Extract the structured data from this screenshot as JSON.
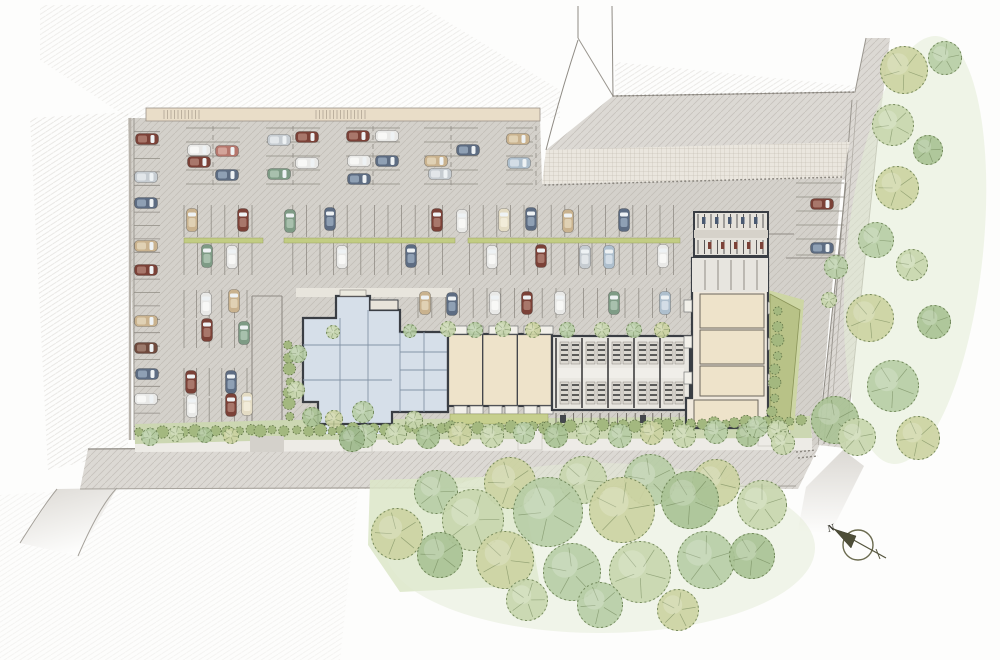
{
  "compass": {
    "label": "N"
  },
  "palette": {
    "background": "#fdfdfc",
    "asphalt": "#d4d1cb",
    "road": "#dcd9d4",
    "plaza": "#eae6de",
    "hatch_line": "#b4b0a8",
    "bg_hatch_line": "#d6d3ce",
    "curb": "#8f8b84",
    "stall_line": "#908c85",
    "wall_tan": "#e9ddc8",
    "building_wall": "#3a3e44",
    "clubhouse_fill": "#d6dfe9",
    "clubhouse_line": "#8494a6",
    "units_tan": "#eee3ca",
    "garage_fill": "#e9e7e1",
    "garage_unit": "#dcd9d2",
    "planter": "#c6cf8e",
    "median_green": "#c2cc83",
    "landscape_band": "#ccd7b2",
    "lawn": "#dce6c8",
    "sidewalk": "#edebe6",
    "green_wedge": "#b8c287",
    "shrub_fill": "#a3b87f",
    "shrub_stroke": "#5c6f42",
    "tree_stroke": "#5f7547",
    "compass_stroke": "#6b6b4f",
    "compass_fill": "#4e4e38",
    "greens": [
      "#c8d6ae",
      "#ccd2a2",
      "#b7cda6",
      "#a9c295",
      "#d8e0bf",
      "#9db88c"
    ]
  },
  "car_colors": {
    "maroon": [
      "#7b4137",
      "#a8776b"
    ],
    "brown": [
      "#6f4a3d",
      "#9c7a6c"
    ],
    "white": [
      "#e9e9e7",
      "#f8f8f6"
    ],
    "silver": [
      "#c6ccd1",
      "#e2e6e9"
    ],
    "slate": [
      "#5d6c82",
      "#8fa0b4"
    ],
    "lightblue": [
      "#aebfcd",
      "#d3dde6"
    ],
    "green": [
      "#7e9b85",
      "#a8c0ad"
    ],
    "tan": [
      "#c9b28e",
      "#e0d1b4"
    ],
    "cream": [
      "#e4dcc4",
      "#f2ecd9"
    ],
    "red": [
      "#b5766c",
      "#d3a49a"
    ]
  },
  "site": {
    "asphalt": "128,118 540,118 542,184 842,178 818,445 135,445",
    "plaza": "542,184 546,150 850,142 842,178",
    "top_road": "546,150 613,96 855,92 866,38 890,38 878,135 846,180",
    "diag_road": "846,180 878,135 845,448 818,445",
    "diag_stub": "806,487 843,450 864,466 830,534 798,530",
    "bottom_road": "88,449 820,444 798,489 80,489",
    "branch_road": "57,489 117,488 78,556 20,543",
    "white_block_outline": "578,38 613,96 855,92 866,38",
    "landscape_band_east": "286,420 810,416 812,438 286,440",
    "landscape_band_west": "135,424 286,420 286,440 135,444",
    "sidewalk_band": "135,437 812,433 812,450 135,452",
    "lawn": "370,480 520,476 540,585 400,592 368,545",
    "hatch_patches": [
      {
        "pts": "30,118 128,112 128,452 48,470",
        "o": 0.6
      },
      {
        "pts": "40,5 420,5 560,90 560,118 128,118 40,60",
        "o": 0.45
      },
      {
        "pts": "0,495 360,472 340,660 0,660",
        "o": 0.28
      },
      {
        "pts": "615,62 855,86 855,95 615,96",
        "o": 0.55
      }
    ],
    "wall": {
      "x": 146,
      "y": 108,
      "w": 394,
      "h": 13,
      "tick_groups": [
        [
          164,
          202
        ],
        [
          316,
          366
        ]
      ]
    },
    "drive": {
      "x1": 252,
      "x2": 282,
      "y1": 296,
      "y2": 448
    },
    "paths": [
      {
        "x": 344,
        "y": 430,
        "w": 28,
        "h": 22
      },
      {
        "x": 518,
        "y": 426,
        "w": 24,
        "h": 24
      },
      {
        "x": 758,
        "y": 416,
        "w": 32,
        "h": 30
      }
    ],
    "stalls": {
      "top_pairs": [
        {
          "x": 186,
          "cols": 2
        },
        {
          "x": 266,
          "cols": 2
        },
        {
          "x": 346,
          "cols": 2
        },
        {
          "x": 424,
          "cols": 2
        },
        {
          "x": 506,
          "cols": 1
        }
      ],
      "top_rows_y": [
        128,
        142,
        156,
        170,
        184
      ],
      "median": {
        "x0": 184,
        "x1": 680,
        "step": 13.6,
        "top": [
          205,
          237
        ],
        "bot": [
          243,
          275
        ],
        "strip_y": 238,
        "strip_h": 5,
        "gaps": [
          [
            263,
            284
          ],
          [
            455,
            468
          ]
        ]
      },
      "row3": {
        "x0": 418,
        "x1": 694,
        "step": 13.8,
        "y0": 288,
        "y1": 318
      },
      "left_upper": {
        "x0": 184,
        "x1": 252,
        "step": 12.6,
        "bands": [
          [
            290,
            318
          ],
          [
            320,
            348
          ]
        ]
      },
      "left_lower": {
        "x0": 184,
        "x1": 252,
        "step": 12.6,
        "bands": [
          [
            368,
            396
          ],
          [
            398,
            426
          ]
        ]
      },
      "right": {
        "ys": [
          183,
          197,
          211,
          225,
          239,
          255
        ],
        "x0": 796,
        "x1": 844
      },
      "left_col": {
        "y0": 131.7,
        "y1": 432,
        "step": 13.4,
        "x0": 134,
        "x1": 160
      }
    }
  },
  "buildings": {
    "clubhouse": {
      "outline": "M303,318 L336,318 L336,296 L370,296 L370,310 L400,310 L400,332 L448,332 L448,412 L392,412 L392,424 L318,424 L318,402 L303,402 Z",
      "entry": {
        "x": 340,
        "y": 290,
        "w": 26,
        "h": 6
      },
      "portico": {
        "x": 370,
        "y": 300,
        "w": 28,
        "h": 10
      },
      "north_walk": {
        "x": 296,
        "y": 288,
        "w": 156,
        "h": 9
      },
      "south_patio": {
        "x": 322,
        "y": 424,
        "w": 68,
        "h": 10
      }
    },
    "units_a": {
      "x": 448,
      "y": 334,
      "w": 104,
      "h": 72,
      "dividers": [
        482.7,
        517.3
      ],
      "stoop_xs": [
        454,
        470,
        489,
        505,
        524,
        540
      ],
      "planter": {
        "x": 450,
        "y": 414,
        "w": 98,
        "h": 10
      }
    },
    "garage": {
      "x": 552,
      "y": 336,
      "w": 138,
      "h": 74,
      "band_xs": [
        560,
        586,
        612,
        638,
        664
      ],
      "corridor_y": 368,
      "corridor_h": 10,
      "bike_row": {
        "x0": 556,
        "x1": 688,
        "step": 8.8,
        "y0": 413,
        "y1": 426
      }
    },
    "right_bldg": {
      "outline": "M692,258 L768,258 L768,428 L686,428 L686,398 L692,398 Z",
      "top_rooms": {
        "x": 692,
        "y": 258,
        "w": 76,
        "h": 34,
        "div_xs": [
          705,
          718,
          731,
          744,
          757
        ]
      },
      "units": [
        [
          700,
          294,
          64,
          34
        ],
        [
          700,
          330,
          64,
          34
        ],
        [
          700,
          366,
          64,
          30
        ],
        [
          694,
          400,
          64,
          26
        ]
      ],
      "balconies_w": [
        [
          684,
          300
        ],
        [
          684,
          336
        ],
        [
          684,
          372
        ]
      ],
      "balconies_e": [
        [
          768,
          302
        ],
        [
          768,
          338
        ],
        [
          768,
          374
        ]
      ],
      "wedge_outer": "768,290 804,300 794,430 768,432",
      "wedge_inner": "770,294 800,310 790,420 770,426",
      "carport": {
        "x": 694,
        "y": 212,
        "w": 74,
        "h": 44,
        "mid_y": 230,
        "mid_h": 8
      }
    }
  },
  "cars": [
    [
      147,
      139,
      "h",
      "maroon"
    ],
    [
      146,
      177,
      "h",
      "silver"
    ],
    [
      146,
      203,
      "h",
      "slate"
    ],
    [
      146,
      246,
      "h",
      "tan"
    ],
    [
      146,
      270,
      "h",
      "maroon"
    ],
    [
      146,
      321,
      "h",
      "tan"
    ],
    [
      146,
      348,
      "h",
      "brown"
    ],
    [
      147,
      374,
      "h",
      "slate"
    ],
    [
      146,
      399,
      "h",
      "white"
    ],
    [
      199,
      150,
      "h",
      "white"
    ],
    [
      199,
      162,
      "h",
      "maroon"
    ],
    [
      227,
      151,
      "h",
      "red"
    ],
    [
      227,
      175,
      "h",
      "slate"
    ],
    [
      279,
      140,
      "h",
      "silver"
    ],
    [
      279,
      174,
      "h",
      "green"
    ],
    [
      307,
      137,
      "h",
      "maroon"
    ],
    [
      307,
      163,
      "h",
      "white"
    ],
    [
      358,
      136,
      "h",
      "maroon"
    ],
    [
      359,
      161,
      "h",
      "white"
    ],
    [
      359,
      179,
      "h",
      "slate"
    ],
    [
      387,
      136,
      "h",
      "white"
    ],
    [
      387,
      161,
      "h",
      "slate"
    ],
    [
      436,
      161,
      "h",
      "tan"
    ],
    [
      440,
      174,
      "h",
      "silver"
    ],
    [
      468,
      150,
      "h",
      "slate"
    ],
    [
      518,
      139,
      "h",
      "tan"
    ],
    [
      519,
      163,
      "h",
      "lightblue"
    ],
    [
      192,
      220,
      "v",
      "tan"
    ],
    [
      243,
      220,
      "v",
      "maroon"
    ],
    [
      290,
      221,
      "v",
      "green"
    ],
    [
      330,
      219,
      "v",
      "slate"
    ],
    [
      437,
      220,
      "v",
      "maroon"
    ],
    [
      462,
      221,
      "v",
      "white"
    ],
    [
      504,
      220,
      "v",
      "cream"
    ],
    [
      531,
      219,
      "v",
      "slate"
    ],
    [
      568,
      221,
      "v",
      "tan"
    ],
    [
      624,
      220,
      "v",
      "slate"
    ],
    [
      207,
      256,
      "v",
      "green"
    ],
    [
      232,
      257,
      "v",
      "white"
    ],
    [
      342,
      257,
      "v",
      "white"
    ],
    [
      411,
      256,
      "v",
      "slate"
    ],
    [
      492,
      257,
      "v",
      "white"
    ],
    [
      541,
      256,
      "v",
      "maroon"
    ],
    [
      585,
      257,
      "v",
      "silver"
    ],
    [
      609,
      257,
      "v",
      "lightblue"
    ],
    [
      663,
      256,
      "v",
      "white"
    ],
    [
      425,
      303,
      "v",
      "tan"
    ],
    [
      452,
      304,
      "v",
      "slate"
    ],
    [
      495,
      303,
      "v",
      "white"
    ],
    [
      527,
      303,
      "v",
      "maroon"
    ],
    [
      560,
      303,
      "v",
      "white"
    ],
    [
      614,
      303,
      "v",
      "green"
    ],
    [
      665,
      303,
      "v",
      "lightblue"
    ],
    [
      206,
      304,
      "v",
      "white"
    ],
    [
      234,
      301,
      "v",
      "tan"
    ],
    [
      207,
      330,
      "v",
      "maroon"
    ],
    [
      244,
      333,
      "v",
      "green"
    ],
    [
      191,
      382,
      "v",
      "maroon"
    ],
    [
      192,
      406,
      "v",
      "white"
    ],
    [
      231,
      382,
      "v",
      "slate"
    ],
    [
      231,
      405,
      "v",
      "maroon"
    ],
    [
      247,
      404,
      "v",
      "cream"
    ],
    [
      822,
      204,
      "h",
      "maroon"
    ],
    [
      822,
      248,
      "h",
      "slate"
    ]
  ],
  "trees": [
    [
      448,
      329,
      8,
      0
    ],
    [
      475,
      330,
      8,
      2
    ],
    [
      503,
      329,
      8,
      0
    ],
    [
      533,
      330,
      8,
      1
    ],
    [
      567,
      330,
      8,
      2
    ],
    [
      602,
      330,
      8,
      0
    ],
    [
      634,
      330,
      8,
      2
    ],
    [
      662,
      330,
      8,
      1
    ],
    [
      333,
      332,
      7,
      0
    ],
    [
      410,
      331,
      7,
      2
    ],
    [
      365,
      436,
      12,
      2
    ],
    [
      396,
      434,
      11,
      0
    ],
    [
      428,
      437,
      12,
      3
    ],
    [
      460,
      434,
      12,
      1
    ],
    [
      492,
      436,
      12,
      0
    ],
    [
      524,
      433,
      11,
      2
    ],
    [
      556,
      436,
      12,
      3
    ],
    [
      588,
      433,
      12,
      0
    ],
    [
      620,
      436,
      12,
      2
    ],
    [
      652,
      433,
      12,
      1
    ],
    [
      684,
      436,
      12,
      0
    ],
    [
      716,
      432,
      12,
      2
    ],
    [
      748,
      435,
      12,
      3
    ],
    [
      778,
      431,
      11,
      0
    ],
    [
      150,
      437,
      9,
      2
    ],
    [
      176,
      434,
      8,
      0
    ],
    [
      205,
      435,
      8,
      3
    ],
    [
      231,
      436,
      8,
      1
    ],
    [
      298,
      354,
      9,
      2
    ],
    [
      296,
      390,
      9,
      0
    ],
    [
      312,
      417,
      10,
      3
    ],
    [
      334,
      419,
      9,
      1
    ],
    [
      363,
      412,
      11,
      2
    ],
    [
      352,
      439,
      13,
      5
    ],
    [
      414,
      420,
      9,
      0
    ],
    [
      757,
      427,
      11,
      2
    ],
    [
      783,
      443,
      12,
      0
    ],
    [
      835,
      420,
      24,
      3
    ],
    [
      836,
      267,
      12,
      2
    ],
    [
      829,
      300,
      8,
      0
    ],
    [
      904,
      70,
      24,
      1
    ],
    [
      945,
      58,
      17,
      2
    ],
    [
      893,
      125,
      21,
      0
    ],
    [
      928,
      150,
      15,
      3
    ],
    [
      897,
      188,
      22,
      1
    ],
    [
      876,
      240,
      18,
      2
    ],
    [
      912,
      265,
      16,
      0
    ],
    [
      870,
      318,
      24,
      1
    ],
    [
      934,
      322,
      17,
      3
    ],
    [
      893,
      386,
      26,
      2
    ],
    [
      857,
      437,
      19,
      0
    ],
    [
      918,
      438,
      22,
      1
    ],
    [
      436,
      492,
      22,
      2
    ],
    [
      510,
      483,
      26,
      1
    ],
    [
      583,
      480,
      24,
      0
    ],
    [
      650,
      480,
      26,
      2
    ],
    [
      716,
      483,
      24,
      1
    ],
    [
      762,
      505,
      25,
      0
    ],
    [
      690,
      500,
      29,
      3
    ],
    [
      622,
      510,
      33,
      1
    ],
    [
      548,
      512,
      35,
      2
    ],
    [
      473,
      520,
      31,
      0
    ],
    [
      440,
      555,
      23,
      3
    ],
    [
      505,
      560,
      29,
      1
    ],
    [
      572,
      572,
      29,
      2
    ],
    [
      640,
      572,
      31,
      0
    ],
    [
      706,
      560,
      29,
      2
    ],
    [
      752,
      556,
      23,
      3
    ],
    [
      678,
      610,
      21,
      1
    ],
    [
      600,
      605,
      23,
      2
    ],
    [
      527,
      600,
      21,
      0
    ],
    [
      397,
      534,
      26,
      1
    ]
  ],
  "shrub_rows": [
    [
      140,
      433,
      283,
      430,
      14
    ],
    [
      298,
      431,
      452,
      427,
      15
    ],
    [
      455,
      429,
      545,
      427,
      9
    ],
    [
      548,
      427,
      690,
      424,
      14
    ],
    [
      692,
      424,
      800,
      421,
      11
    ],
    [
      289,
      346,
      289,
      416,
      7
    ],
    [
      779,
      312,
      773,
      412,
      8
    ]
  ]
}
